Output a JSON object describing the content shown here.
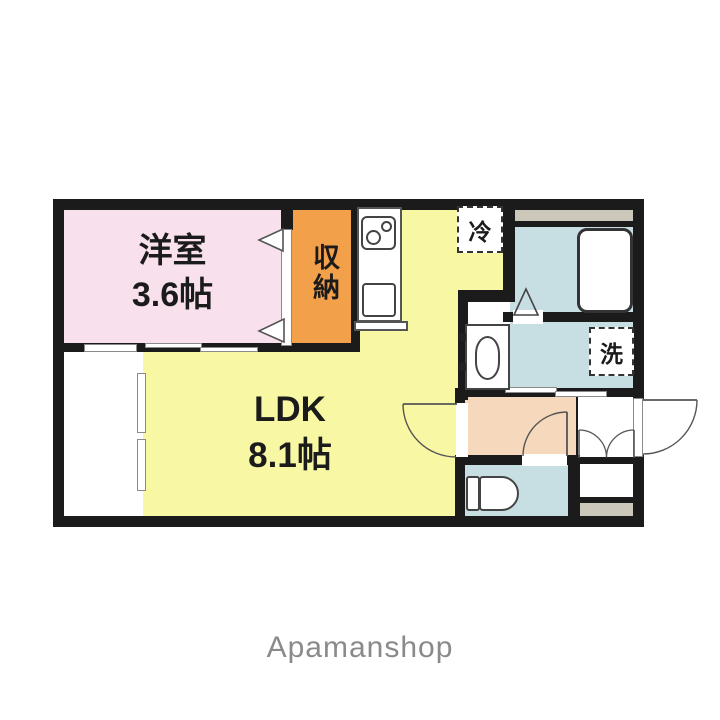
{
  "plan": {
    "title": "1LDK apartment floor plan",
    "rooms": {
      "western": {
        "name": "洋室",
        "size": "3.6帖"
      },
      "ldk": {
        "name": "LDK",
        "size": "8.1帖"
      },
      "closet": {
        "label": "収納"
      },
      "fridge": {
        "label": "冷"
      },
      "washer": {
        "label": "洗"
      }
    },
    "fixtures": [
      "bathtub",
      "kitchen-stove-2-burner",
      "kitchen-sink",
      "washbasin",
      "toilet",
      "refrigerator-space",
      "washing-machine-space",
      "shoe-cabinet",
      "entrance-porch"
    ],
    "colors": {
      "wall": "#1b1b1b",
      "western_pink": "#f8e1ec",
      "closet_orange": "#f3a04b",
      "ldk_yellow": "#f8f7a3",
      "wet_area_blue": "#c7dee2",
      "hall_peach": "#f6d9bc",
      "porch_gray": "#cbc7ba"
    }
  },
  "brand": {
    "text": "Apamanshop",
    "color": "#8a8a8a"
  }
}
